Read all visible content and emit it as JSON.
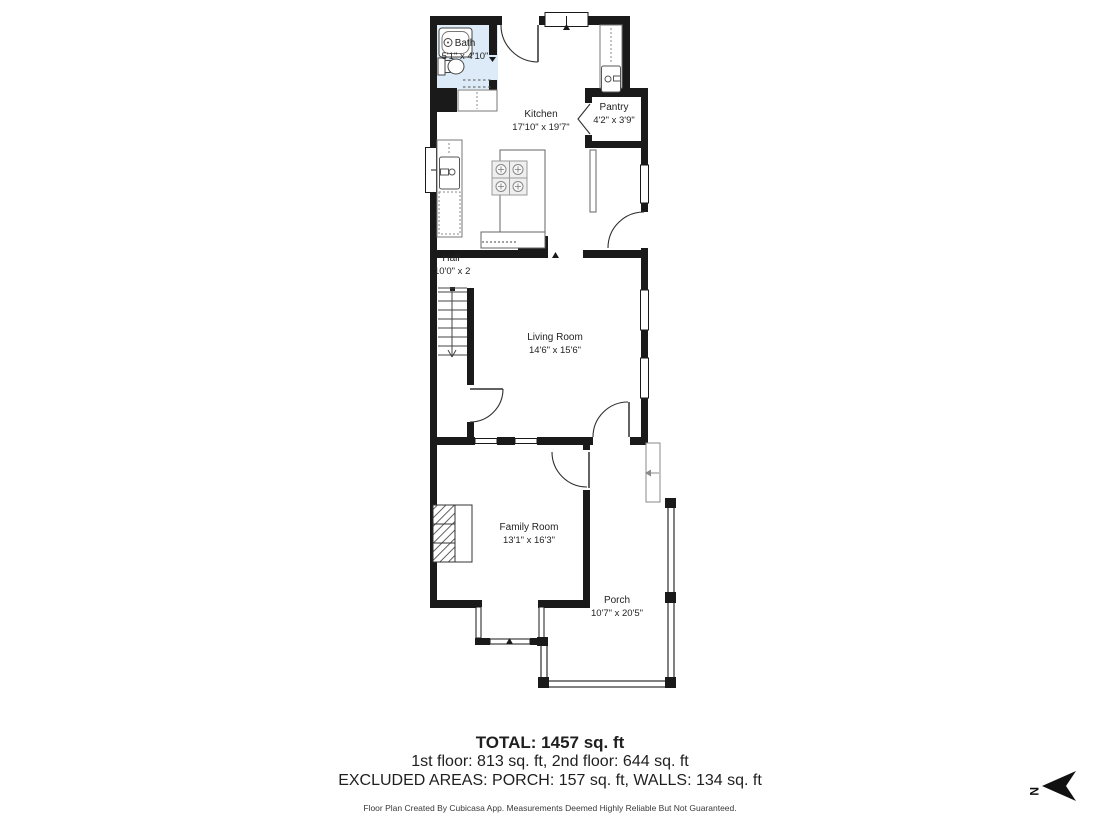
{
  "rooms": {
    "bath": {
      "name": "Bath",
      "dims": "5'1\" x 4'10\""
    },
    "kitchen": {
      "name": "Kitchen",
      "dims": "17'10\" x 19'7\""
    },
    "pantry": {
      "name": "Pantry",
      "dims": "4'2\" x 3'9\""
    },
    "hall": {
      "name": "Hall",
      "dims": "10'0\" x 2'9\""
    },
    "living_room": {
      "name": "Living Room",
      "dims": "14'6\" x 15'6\""
    },
    "family_room": {
      "name": "Family Room",
      "dims": "13'1\" x 16'3\""
    },
    "porch": {
      "name": "Porch",
      "dims": "10'7\" x 20'5\""
    }
  },
  "summary": {
    "total": "TOTAL: 1457 sq. ft",
    "floors": "1st floor: 813 sq. ft, 2nd floor: 644 sq. ft",
    "excluded": "EXCLUDED AREAS: PORCH: 157 sq. ft, WALLS: 134 sq. ft",
    "disclaimer": "Floor Plan Created By Cubicasa App. Measurements Deemed Highly Reliable But Not Guaranteed."
  },
  "compass": {
    "label": "N"
  },
  "colors": {
    "wall": "#1a1a1a",
    "bath_fill": "#dcebf7",
    "line": "#3c3c3c",
    "text": "#232323"
  }
}
